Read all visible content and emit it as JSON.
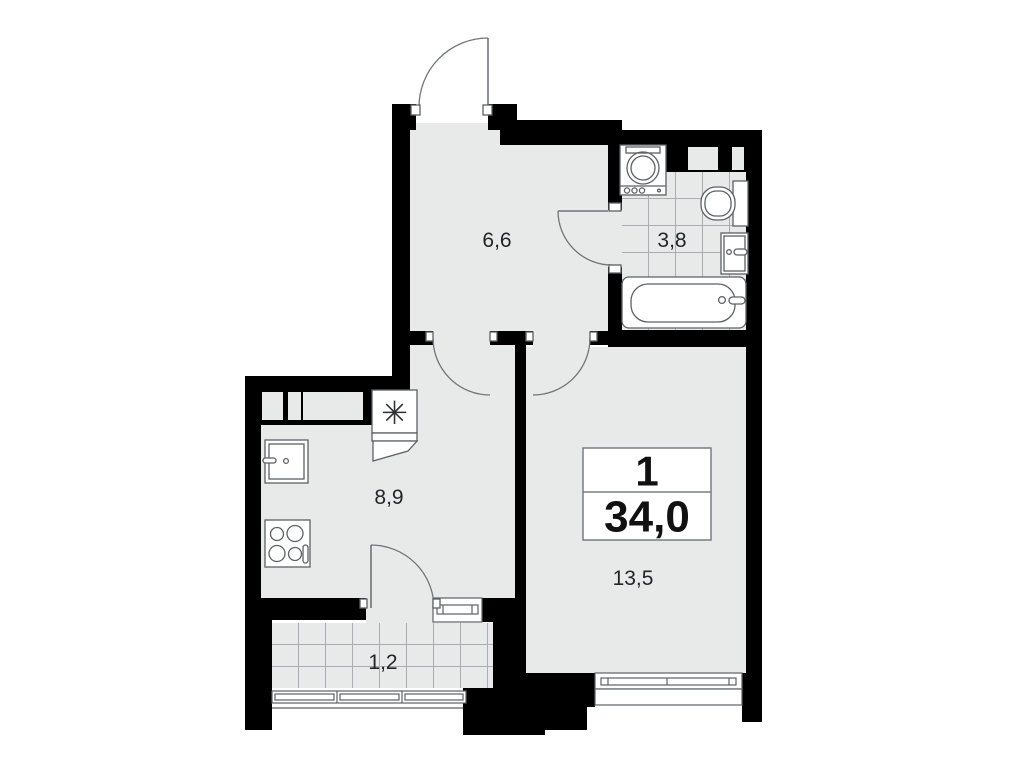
{
  "badge": {
    "rooms_count": "1",
    "total_area": "34,0"
  },
  "room_areas": {
    "hallway": "6,6",
    "bathroom": "3,8",
    "kitchen": "8,9",
    "living_room": "13,5",
    "balcony": "1,2"
  },
  "symbols": {
    "vent_shaft": "✳"
  },
  "colors": {
    "walls": "#000000",
    "floor": "#e8eaea",
    "tile_lines": "#a9aeb2",
    "fixture_lines": "#5c6165",
    "door_arc_lines": "#70757a",
    "background": "#ffffff",
    "label_text": "#1f2428"
  }
}
